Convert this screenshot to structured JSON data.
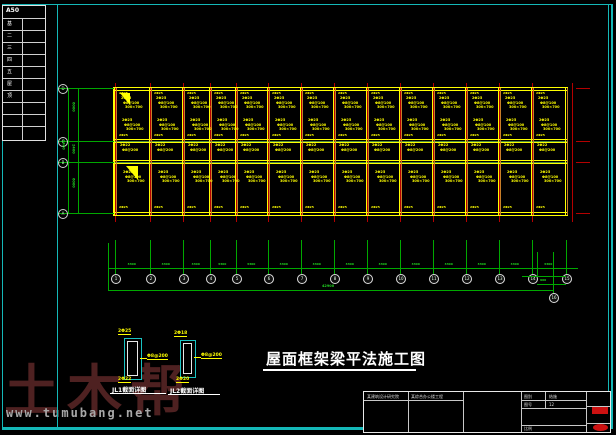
{
  "colors": {
    "frame": "#14b8b8",
    "grid_red": "#b40000",
    "beam_yellow": "#ffff00",
    "beam_orange": "#c87e28",
    "dim_green": "#00a800",
    "beam_green": "#4c8c3c",
    "white": "#ffffff",
    "stamp_red": "#cc1111",
    "watermark_maroon": "#4e2121",
    "url_gray": "#a8a8a8"
  },
  "layer_table": {
    "header": "A50",
    "rows": [
      "基",
      "二",
      "三",
      "四",
      "五",
      "屋",
      "顶",
      "",
      "",
      ""
    ]
  },
  "plan": {
    "column_x": [
      115,
      150,
      183,
      210,
      236,
      268,
      301,
      334,
      367,
      400,
      433,
      466,
      499,
      532
    ],
    "right_x": 566,
    "tick_x": 572,
    "rows_y": [
      88,
      141,
      162,
      213
    ],
    "tick_label": "2Φ25",
    "cluster_upper": [
      "2Φ25",
      "Φ8@100",
      "300×700"
    ],
    "cluster_mid": [
      "2Φ22",
      "Φ8@200"
    ],
    "cluster_lower": [
      "2Φ25",
      "Φ8@100",
      "300×700"
    ],
    "bottom_label": "2Φ25"
  },
  "left_axes": {
    "labels": [
      "D",
      "C",
      "B",
      "A"
    ],
    "dims": [
      "6000",
      "2400",
      "6000"
    ],
    "overall": "8400"
  },
  "bottom_axes": {
    "labels": [
      "1",
      "2",
      "3",
      "4",
      "5",
      "6",
      "7",
      "8",
      "9",
      "10",
      "11",
      "12",
      "13",
      "14",
      "15"
    ],
    "sub_label": "16",
    "bay_dim": "3300",
    "right_dim": "900",
    "overall": "42900"
  },
  "details": {
    "items": [
      {
        "top": "2Φ25",
        "side": "Φ8@200",
        "bot": "2Φ22",
        "caption": "JL1截面详图"
      },
      {
        "top": "2Φ18",
        "side": "Φ8@200",
        "bot": "2Φ20",
        "caption": "JL2截面详图"
      }
    ]
  },
  "title": {
    "text": "屋面框架梁平法施工图"
  },
  "title_block": {
    "company": "某建筑设计研究院",
    "project": "某综合办公楼工程",
    "roles": [
      "设 计",
      "制 图",
      "校 对",
      "审 核",
      "日 期"
    ],
    "type_label": "图别",
    "type_value": "结施",
    "no_label": "图号",
    "no_value": "12",
    "scale_label": "比例"
  },
  "watermark": {
    "brand": "土木帮",
    "url": "www.tumubang.net"
  }
}
